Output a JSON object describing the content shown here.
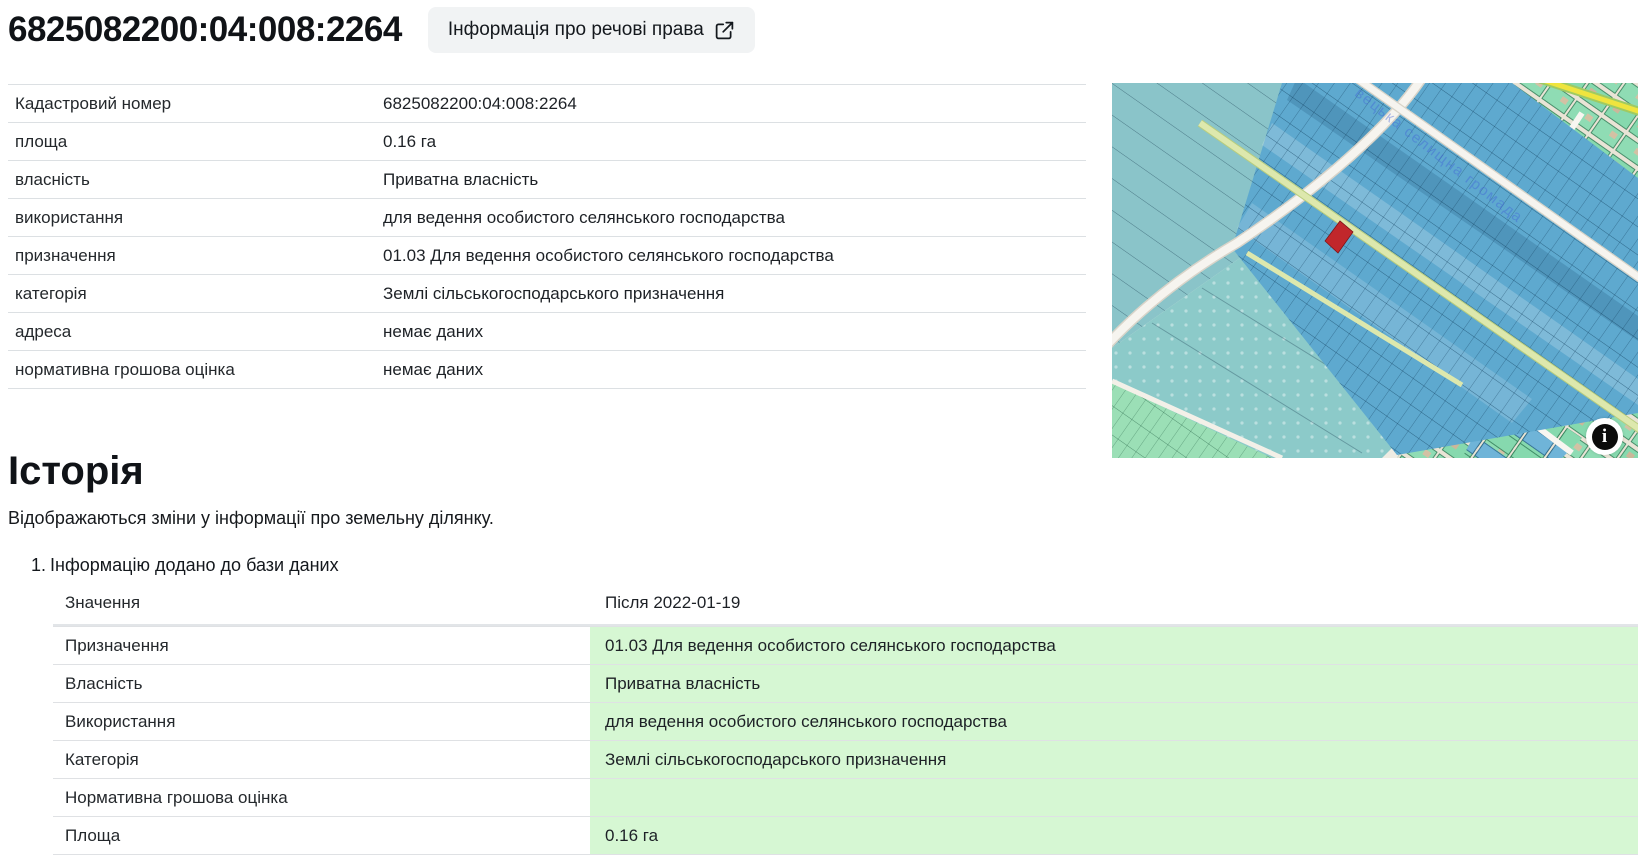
{
  "page": {
    "title": "6825082200:04:008:2264",
    "rights_button_label": "Інформація про речові права"
  },
  "details": {
    "rows": [
      {
        "label": "Кадастровий номер",
        "value": "6825082200:04:008:2264"
      },
      {
        "label": "площа",
        "value": "0.16 га"
      },
      {
        "label": "власність",
        "value": "Приватна власність"
      },
      {
        "label": "використання",
        "value": "для ведення особистого селянського господарства"
      },
      {
        "label": "призначення",
        "value": "01.03 Для ведення особистого селянського господарства"
      },
      {
        "label": "категорія",
        "value": "Землі сільськогосподарського призначення"
      },
      {
        "label": "адреса",
        "value": "немає даних"
      },
      {
        "label": "нормативна грошова оцінка",
        "value": "немає даних"
      }
    ]
  },
  "map": {
    "area_label": "вецька селищна громада",
    "info_icon": "i",
    "colors": {
      "field_teal": "#8ac4c9",
      "parcel_blue": "#5ea9cf",
      "village_green": "#86d9ae",
      "selected_parcel_red": "#c1272b",
      "road_cream": "#f6f4ef",
      "road_yellow": "#efe43e"
    }
  },
  "history": {
    "heading": "Історія",
    "description": "Відображаються зміни у інформації про земельну ділянку.",
    "entries": [
      {
        "index": "1.",
        "title": "Інформацію додано до бази даних",
        "header": {
          "label": "Значення",
          "value": "Після 2022-01-19"
        },
        "rows": [
          {
            "label": "Призначення",
            "value": "01.03 Для ведення особистого селянського господарства"
          },
          {
            "label": "Власність",
            "value": "Приватна власність"
          },
          {
            "label": "Використання",
            "value": "для ведення особистого селянського господарства"
          },
          {
            "label": "Категорія",
            "value": "Землі сільськогосподарського призначення"
          },
          {
            "label": "Нормативна грошова оцінка",
            "value": ""
          },
          {
            "label": "Площа",
            "value": "0.16 га"
          }
        ]
      }
    ]
  }
}
